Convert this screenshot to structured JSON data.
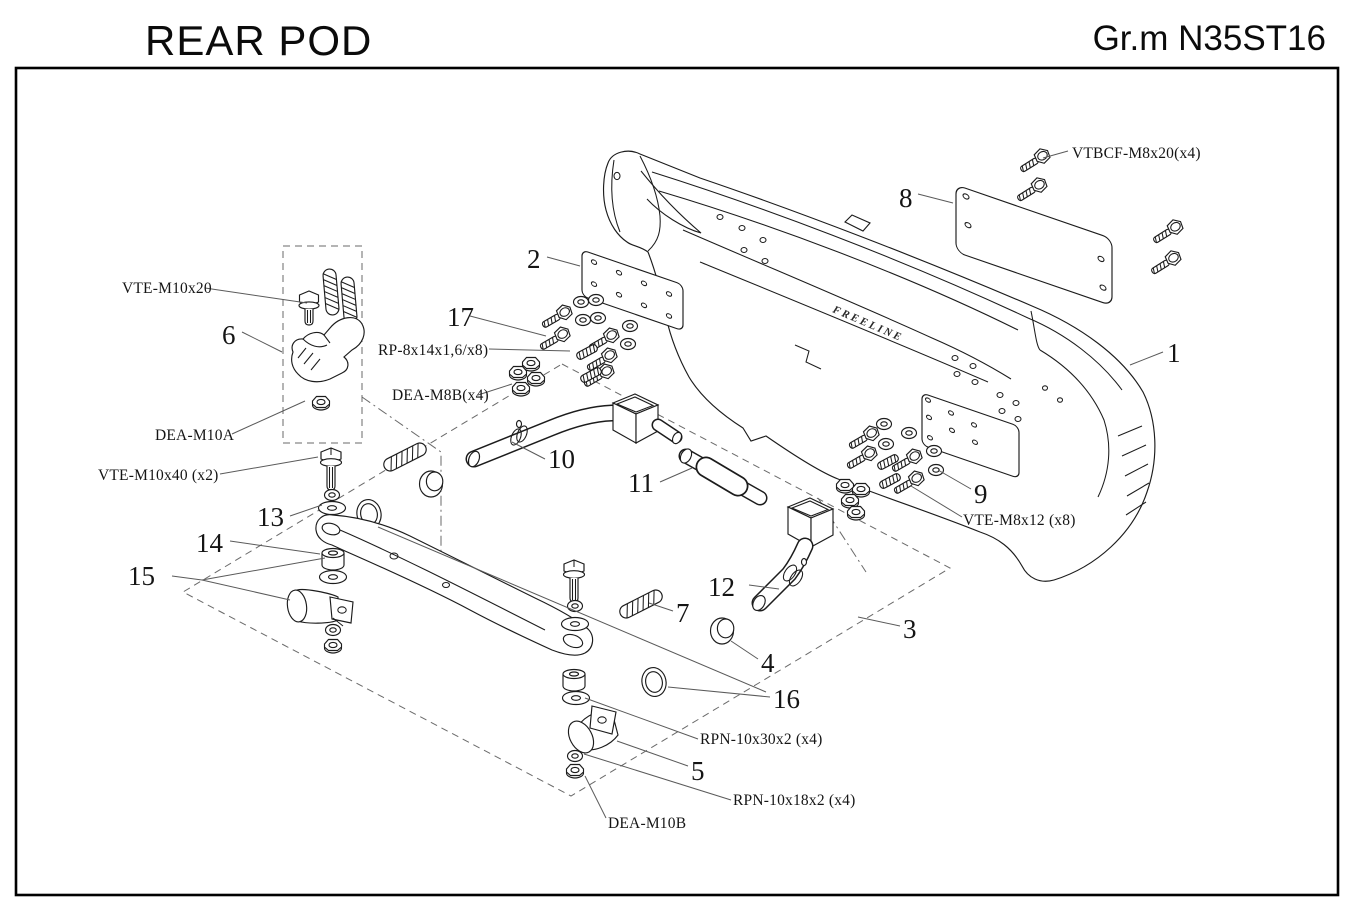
{
  "header": {
    "title": "REAR POD",
    "group_code": "Gr.m N35ST16"
  },
  "diagram": {
    "brand_text": "FREELINE",
    "callouts": {
      "n1": "1",
      "n2": "2",
      "n3": "3",
      "n4": "4",
      "n5": "5",
      "n6": "6",
      "n7": "7",
      "n8": "8",
      "n9": "9",
      "n10": "10",
      "n11": "11",
      "n12": "12",
      "n13": "13",
      "n14": "14",
      "n15": "15",
      "n16": "16",
      "n17": "17"
    },
    "hardware_labels": {
      "vte_m10x20": "VTE-M10x20",
      "dea_m10a": "DEA-M10A",
      "vte_m10x40": "VTE-M10x40 (x2)",
      "rp_8x14": "RP-8x14x1,6/x8)",
      "dea_m8b": "DEA-M8B(x4)",
      "vtbcf_m8x20": "VTBCF-M8x20(x4)",
      "vte_m8x12": "VTE-M8x12 (x8)",
      "rpn_10x30x2": "RPN-10x30x2 (x4)",
      "rpn_10x18x2": "RPN-10x18x2 (x4)",
      "dea_m10b": "DEA-M10B"
    }
  }
}
